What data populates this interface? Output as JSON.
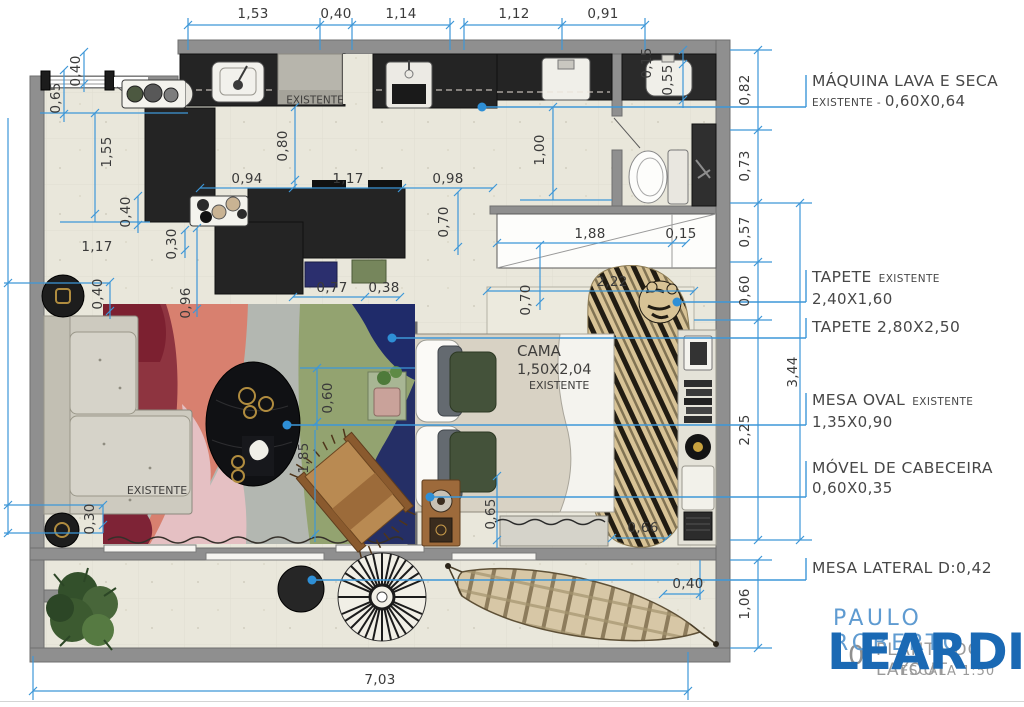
{
  "colors": {
    "dimension_blue": "#3d97d8",
    "leader_dot_blue": "#2e8fd6",
    "wall_gray": "#8f8f8f",
    "floor_beige": "#e9e7db",
    "counter_black": "#242424",
    "logo_blue_light": "#5f9bd1",
    "logo_blue_dark": "#1a69b4"
  },
  "logo": {
    "line1": "PAULO ROBERTO",
    "line2": "LEARDI"
  },
  "watermark": {
    "sheet_number": "0",
    "line1": "PLANTA DO LAYOUT",
    "line2": "ESCALA 1:50"
  },
  "callouts": [
    {
      "id": "maquina-lava-e-seca",
      "title": "MÁQUINA LAVA E SECA",
      "title_suffix": "",
      "line2_small": "EXISTENTE - ",
      "line2": "0,60X0,64",
      "top": 71
    },
    {
      "id": "tapete-existente",
      "title": "TAPETE",
      "title_suffix": "EXISTENTE",
      "line2_small": "",
      "line2": "2,40X1,60",
      "top": 267
    },
    {
      "id": "tapete-280x250",
      "title": "TAPETE 2,80X2,50",
      "title_suffix": "",
      "line2_small": "",
      "line2": "",
      "top": 317
    },
    {
      "id": "mesa-oval",
      "title": "MESA OVAL",
      "title_suffix": "EXISTENTE",
      "line2_small": "",
      "line2": "1,35X0,90",
      "top": 390
    },
    {
      "id": "movel-de-cabeceira",
      "title": "MÓVEL DE CABECEIRA",
      "title_suffix": "",
      "line2_small": "",
      "line2": "0,60X0,35",
      "top": 458
    },
    {
      "id": "mesa-lateral",
      "title": "MESA LATERAL D:0,42",
      "title_suffix": "",
      "line2_small": "",
      "line2": "",
      "top": 558
    }
  ],
  "plan_labels": [
    {
      "id": "kitchen-existente",
      "x": 315,
      "y": 101,
      "align": "center",
      "lines": [
        {
          "text": "EXISTENTE",
          "size": 10.5
        }
      ]
    },
    {
      "id": "bed-label",
      "x": 517,
      "y": 342,
      "align": "left",
      "lines": [
        {
          "text": "CAMA",
          "size": 15
        },
        {
          "text": "1,50X2,04",
          "size": 14.5
        },
        {
          "text": "EXISTENTE",
          "size": 11,
          "indent": 12
        }
      ]
    },
    {
      "id": "sofa-existente",
      "x": 157,
      "y": 491,
      "align": "center",
      "lines": [
        {
          "text": "EXISTENTE",
          "size": 11
        }
      ]
    }
  ],
  "dimensions": [
    {
      "t": "1,53",
      "x": 253,
      "y": 14
    },
    {
      "t": "0,40",
      "x": 336,
      "y": 14
    },
    {
      "t": "1,14",
      "x": 401,
      "y": 14
    },
    {
      "t": "1,12",
      "x": 514,
      "y": 14
    },
    {
      "t": "0,91",
      "x": 603,
      "y": 14
    },
    {
      "t": "0,82",
      "x": 745,
      "y": 90,
      "r": 1
    },
    {
      "t": "0,73",
      "x": 745,
      "y": 166,
      "r": 1
    },
    {
      "t": "0,57",
      "x": 745,
      "y": 232,
      "r": 1
    },
    {
      "t": "0,60",
      "x": 745,
      "y": 291,
      "r": 1
    },
    {
      "t": "2,25",
      "x": 745,
      "y": 430,
      "r": 1
    },
    {
      "t": "3,44",
      "x": 793,
      "y": 372,
      "r": 1
    },
    {
      "t": "1,06",
      "x": 745,
      "y": 604,
      "r": 1
    },
    {
      "t": "7,03",
      "x": 380,
      "y": 680
    },
    {
      "t": "0,65",
      "x": 56,
      "y": 98,
      "r": 1
    },
    {
      "t": "0,40",
      "x": 76,
      "y": 71,
      "r": 1
    },
    {
      "t": "1,55",
      "x": 107,
      "y": 152,
      "r": 1
    },
    {
      "t": "0,40",
      "x": 126,
      "y": 212,
      "r": 1
    },
    {
      "t": "1,17",
      "x": 97,
      "y": 247
    },
    {
      "t": "0,30",
      "x": 172,
      "y": 244,
      "r": 1
    },
    {
      "t": "0,80",
      "x": 283,
      "y": 146,
      "r": 1
    },
    {
      "t": "0,94",
      "x": 247,
      "y": 179
    },
    {
      "t": "1,17",
      "x": 348,
      "y": 179
    },
    {
      "t": "0,98",
      "x": 448,
      "y": 179
    },
    {
      "t": "0,70",
      "x": 444,
      "y": 222,
      "r": 1
    },
    {
      "t": "1,00",
      "x": 540,
      "y": 150,
      "r": 1
    },
    {
      "t": "0,15",
      "x": 647,
      "y": 63,
      "r": 1
    },
    {
      "t": "0,55",
      "x": 668,
      "y": 80,
      "r": 1
    },
    {
      "t": "1,88",
      "x": 590,
      "y": 234
    },
    {
      "t": "0,15",
      "x": 681,
      "y": 234
    },
    {
      "t": "2,22",
      "x": 612,
      "y": 282
    },
    {
      "t": "0,70",
      "x": 526,
      "y": 300,
      "r": 1
    },
    {
      "t": "0,77",
      "x": 332,
      "y": 288
    },
    {
      "t": "0,38",
      "x": 384,
      "y": 288
    },
    {
      "t": "0,96",
      "x": 186,
      "y": 303,
      "r": 1
    },
    {
      "t": "0,40",
      "x": 98,
      "y": 294,
      "r": 1
    },
    {
      "t": "0,60",
      "x": 328,
      "y": 398,
      "r": 1
    },
    {
      "t": "1,85",
      "x": 304,
      "y": 458,
      "r": 1
    },
    {
      "t": "0,30",
      "x": 90,
      "y": 519,
      "r": 1
    },
    {
      "t": "0,65",
      "x": 491,
      "y": 514,
      "r": 1
    },
    {
      "t": "0,66",
      "x": 643,
      "y": 528
    },
    {
      "t": "0,40",
      "x": 688,
      "y": 584
    }
  ]
}
